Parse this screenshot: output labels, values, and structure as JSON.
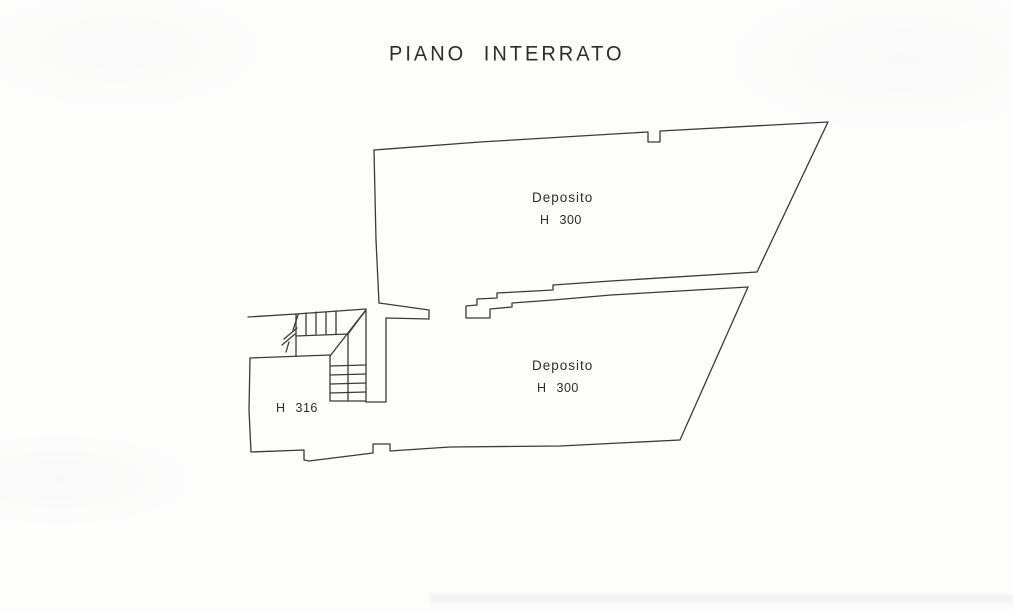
{
  "page": {
    "title": "PIANO INTERRATO"
  },
  "rooms": {
    "deposito_upper": {
      "label": "Deposito",
      "height_label": "H 300"
    },
    "deposito_lower": {
      "label": "Deposito",
      "height_label": "H 300"
    },
    "stair_room": {
      "height_label": "H 316"
    }
  },
  "colors": {
    "line": "#3a3a3a",
    "text": "#2d2d2d",
    "paper": "#fdfdfc"
  }
}
